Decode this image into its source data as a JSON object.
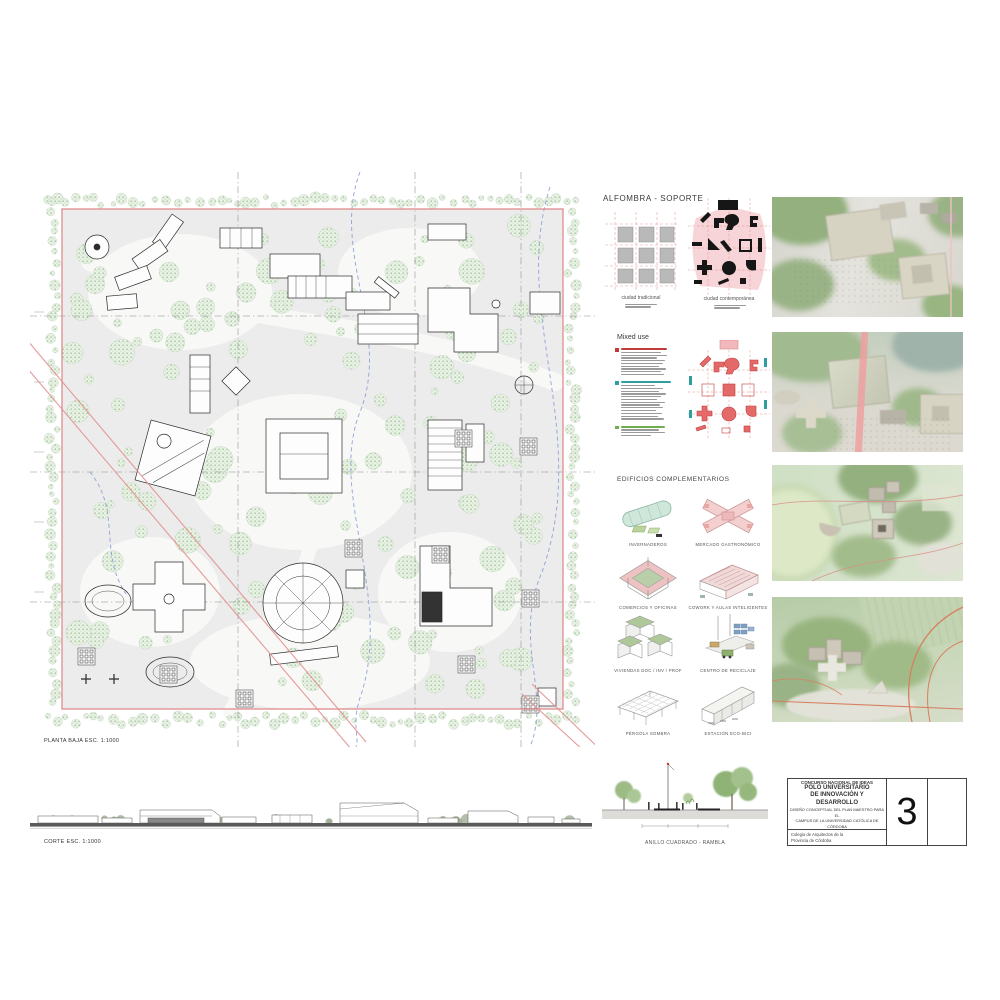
{
  "plan": {
    "label": "PLANTA BAJA ESC. 1:1000"
  },
  "corte": {
    "label": "CORTE ESC. 1:1000"
  },
  "alfombra": {
    "title": "ALFOMBRA - SOPORTE",
    "left_caption": "ciudad tradicional",
    "right_caption": "ciudad contemporánea"
  },
  "mixed_use": {
    "title": "Mixed use",
    "legend": {
      "groups": [
        {
          "name": "group-red",
          "color": "#c23b3b"
        },
        {
          "name": "group-teal",
          "color": "#2f9e9e"
        },
        {
          "name": "group-green",
          "color": "#6fae4f"
        }
      ]
    }
  },
  "complementarios": {
    "title": "EDIFICIOS COMPLEMENTARIOS",
    "items": [
      {
        "label": "INVERNADEROS"
      },
      {
        "label": "MERCADO GASTRONÓMICO"
      },
      {
        "label": "COMERCIOS Y OFICINAS"
      },
      {
        "label": "COWORK Y AULAS INTELIGENTES"
      },
      {
        "label": "VIVIENDAS DOC / INV / PROF"
      },
      {
        "label": "CENTRO DE RECICLAJE"
      },
      {
        "label": "PÉRGOLA SOMBRA"
      },
      {
        "label": "ESTACIÓN ECO-BICI"
      }
    ]
  },
  "street_section": {
    "caption": "ANILLO CUADRADO - RAMBLA"
  },
  "title_block": {
    "line1": "CONCURSO NACIONAL DE IDEAS",
    "line2": "POLO UNIVERSITARIO",
    "line3": "DE INNOVACIÓN Y DESARROLLO",
    "line4": "DISEÑO CONCEPTUAL DEL PLAN MAESTRO PARA EL",
    "line5": "CAMPUS DE LA UNIVERSIDAD CATÓLICA DE CÓRDOBA",
    "organizer_line1": "Colegio de Arquitectos de la",
    "organizer_line2": "Provincia de Córdoba",
    "board_number": "3"
  },
  "colors": {
    "accent_red": "#e08d8d",
    "plan_gray": "#ececec",
    "tree_green": "#a3c79f",
    "legend_red": "#c23b3b",
    "legend_teal": "#2f9e9e",
    "legend_green": "#6fae4f"
  }
}
